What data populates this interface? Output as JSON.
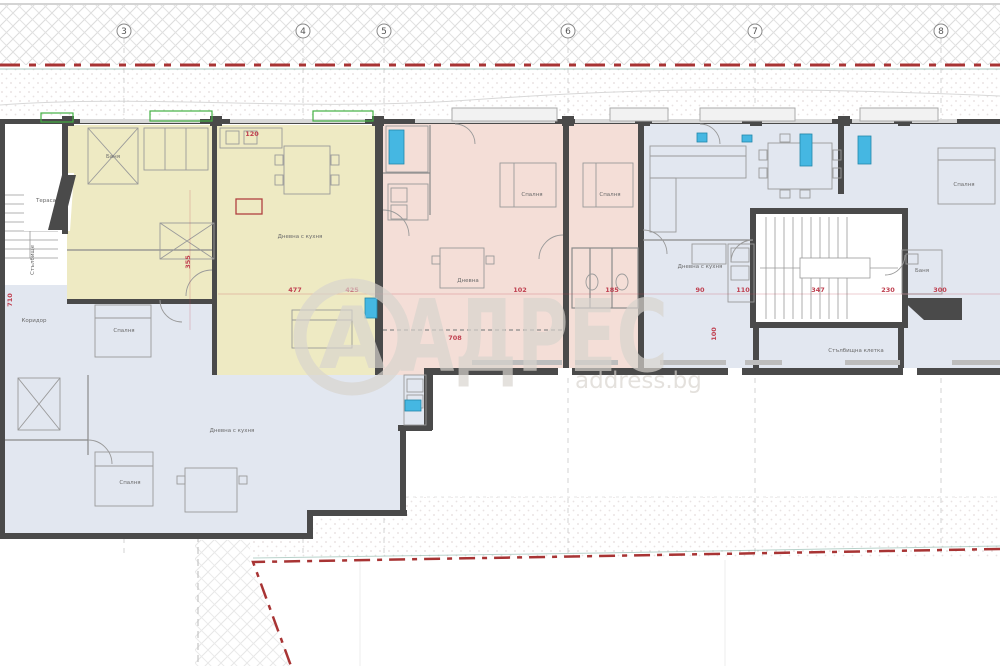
{
  "grid": {
    "labels": [
      "3",
      "4",
      "5",
      "6",
      "7",
      "8"
    ]
  },
  "watermark": {
    "logo_letter": "A",
    "brand": "АДРЕС",
    "website": "address.bg"
  },
  "colors": {
    "apartment_yellow": "#EEEAC3",
    "apartment_pink": "#F4DED7",
    "apartment_blue": "#E2E7F0",
    "wall_dark": "#4A4A4A",
    "window_gray": "#D9D9D9",
    "dimension_red": "#C04050",
    "boundary_red": "#A83434",
    "fixture_blue": "#45B7E2",
    "balcony_green": "#43B043",
    "watermark_gray": "#D8D4CE"
  },
  "labels": {
    "rooms": [
      "Стълбище",
      "Тераса",
      "Баня",
      "Дневна с кухня",
      "Спалня",
      "Спалня",
      "Спалня",
      "Дневна",
      "Дневна с кухня",
      "Стълбищна клетка",
      "Баня",
      "Спалня",
      "Коридор",
      "Спалня",
      "Дневна с кухня"
    ],
    "dims": [
      "355",
      "710",
      "477",
      "102",
      "185",
      "708",
      "347",
      "230",
      "110",
      "120",
      "90",
      "100",
      "300",
      "425"
    ]
  }
}
